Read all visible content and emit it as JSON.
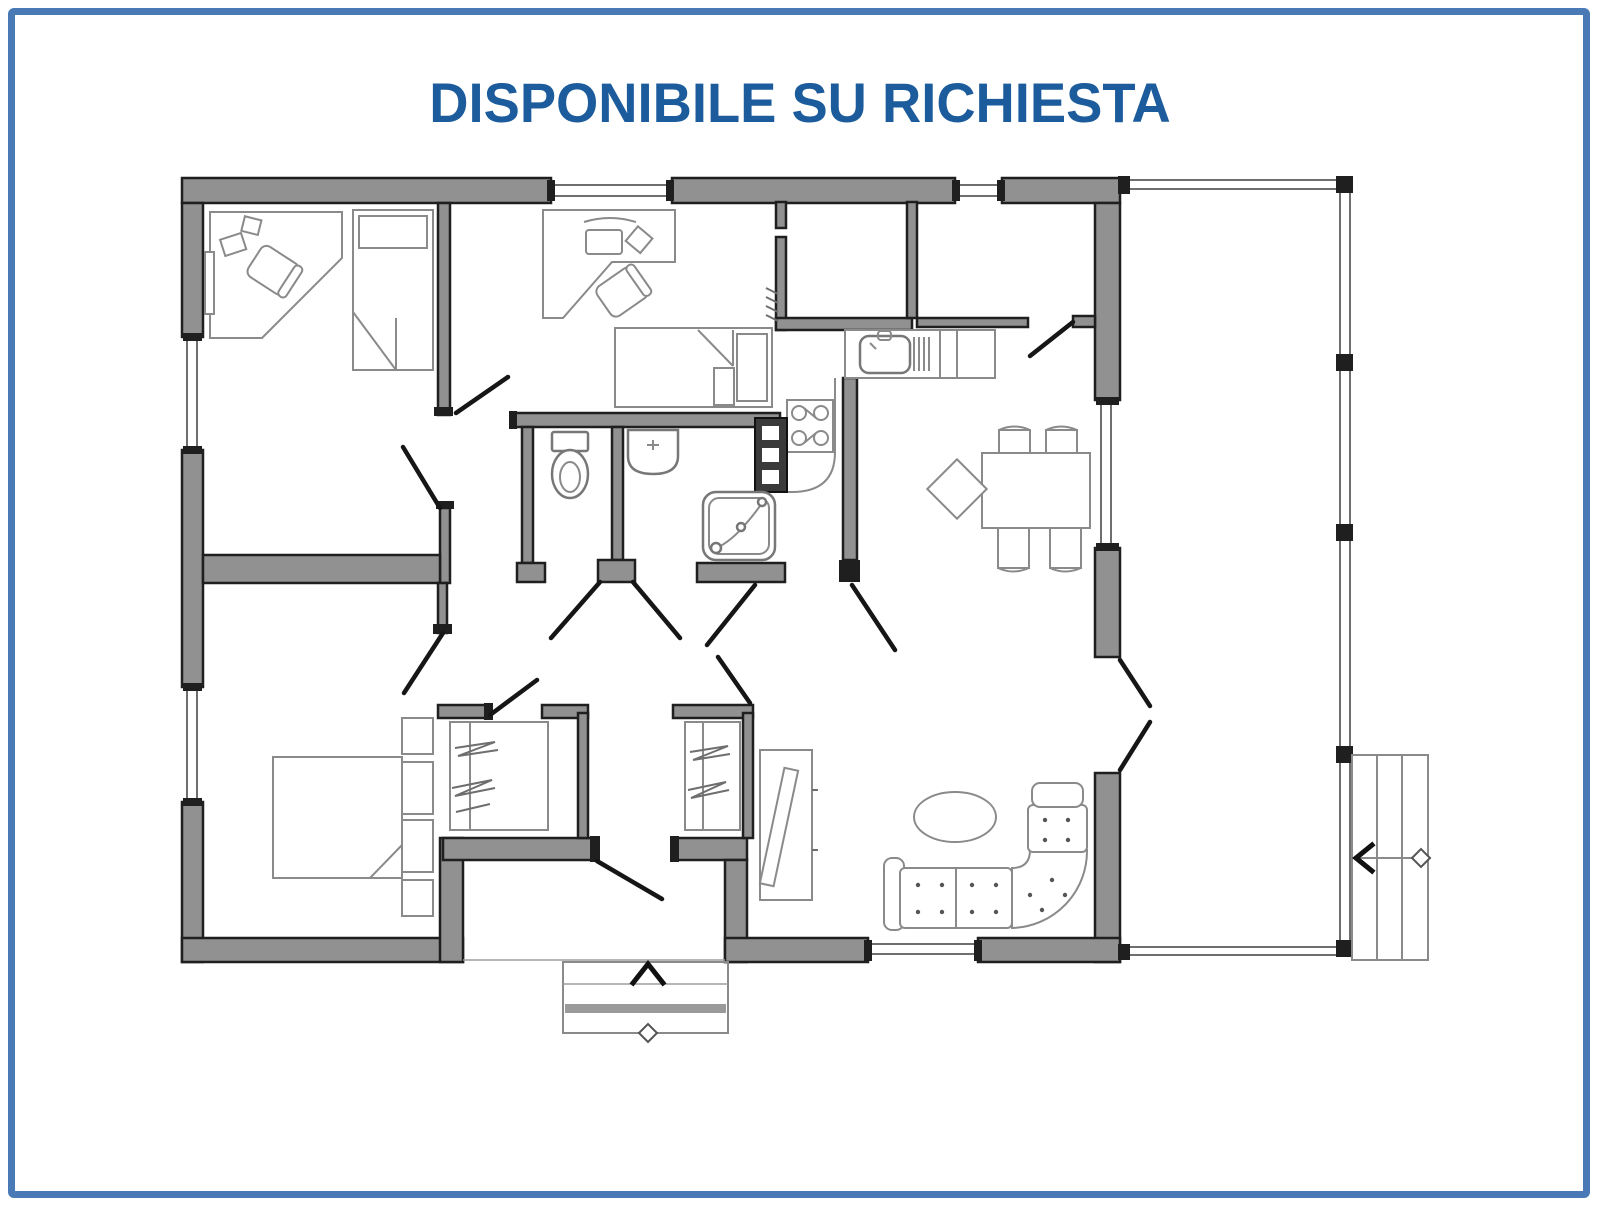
{
  "title": {
    "text": "DISPONIBILE SU RICHIESTA"
  },
  "theme": {
    "page_bg": "#ffffff",
    "frame_border": "#4a7ab5",
    "title_color": "#1c5c9c",
    "wall_fill": "#919191",
    "wall_stroke": "#1f1f1f",
    "door_stroke": "#161616",
    "furniture_stroke": "#8a8a8a",
    "fixture_stroke": "#777777",
    "appliance_dark": "#3a3a3a"
  },
  "floor_plan": {
    "type": "single-storey house plan, no dimension labels",
    "rooms": [
      {
        "id": "bedroom-1",
        "contents": [
          "corner-desk",
          "desk-chair",
          "single-bed"
        ]
      },
      {
        "id": "bedroom-2",
        "contents": [
          "desk",
          "desk-chair",
          "single-bed"
        ]
      },
      {
        "id": "bedroom-3",
        "contents": [
          "double-bed",
          "two-pillows",
          "two-nightstands"
        ]
      },
      {
        "id": "bathroom",
        "contents": [
          "toilet",
          "washbasin",
          "shower-cabin"
        ]
      },
      {
        "id": "storage-room-1",
        "contents": [
          "radiator"
        ]
      },
      {
        "id": "storage-room-2",
        "contents": []
      },
      {
        "id": "kitchen",
        "contents": [
          "sink-counter",
          "drainer",
          "cooktop-4-burners",
          "tall-appliance-column"
        ]
      },
      {
        "id": "living-dining-room",
        "contents": [
          "dining-table",
          "five-chairs",
          "corner-sofa",
          "oval-coffee-table",
          "tv-sideboard"
        ]
      },
      {
        "id": "hallway",
        "contents": []
      },
      {
        "id": "wardrobe-closet-1",
        "contents": [
          "clothes-rail"
        ]
      },
      {
        "id": "wardrobe-closet-2",
        "contents": [
          "clothes-rail"
        ]
      },
      {
        "id": "entry-vestibule",
        "contents": [
          "front-door"
        ]
      },
      {
        "id": "porch-veranda",
        "contents": [
          "posts"
        ]
      }
    ],
    "openings": {
      "windows": [
        "top-wall-window-1",
        "top-wall-window-2",
        "west-wall-window-1",
        "west-wall-window-2",
        "east-wall-window",
        "south-wall-window"
      ],
      "doors": [
        "bedroom-1-door",
        "bedroom-2-door",
        "bedroom-3-door",
        "bathroom-wc-door",
        "bathroom-shower-door",
        "kitchen-door",
        "closet-1-door",
        "closet-2-door",
        "storage-2-door",
        "front-door",
        "porch-double-door"
      ]
    },
    "annotations": [
      {
        "id": "entry-steps",
        "symbol": "up-arrow-and-diamond"
      },
      {
        "id": "porch-side-steps",
        "symbol": "left-arrow-and-diamond"
      }
    ]
  }
}
